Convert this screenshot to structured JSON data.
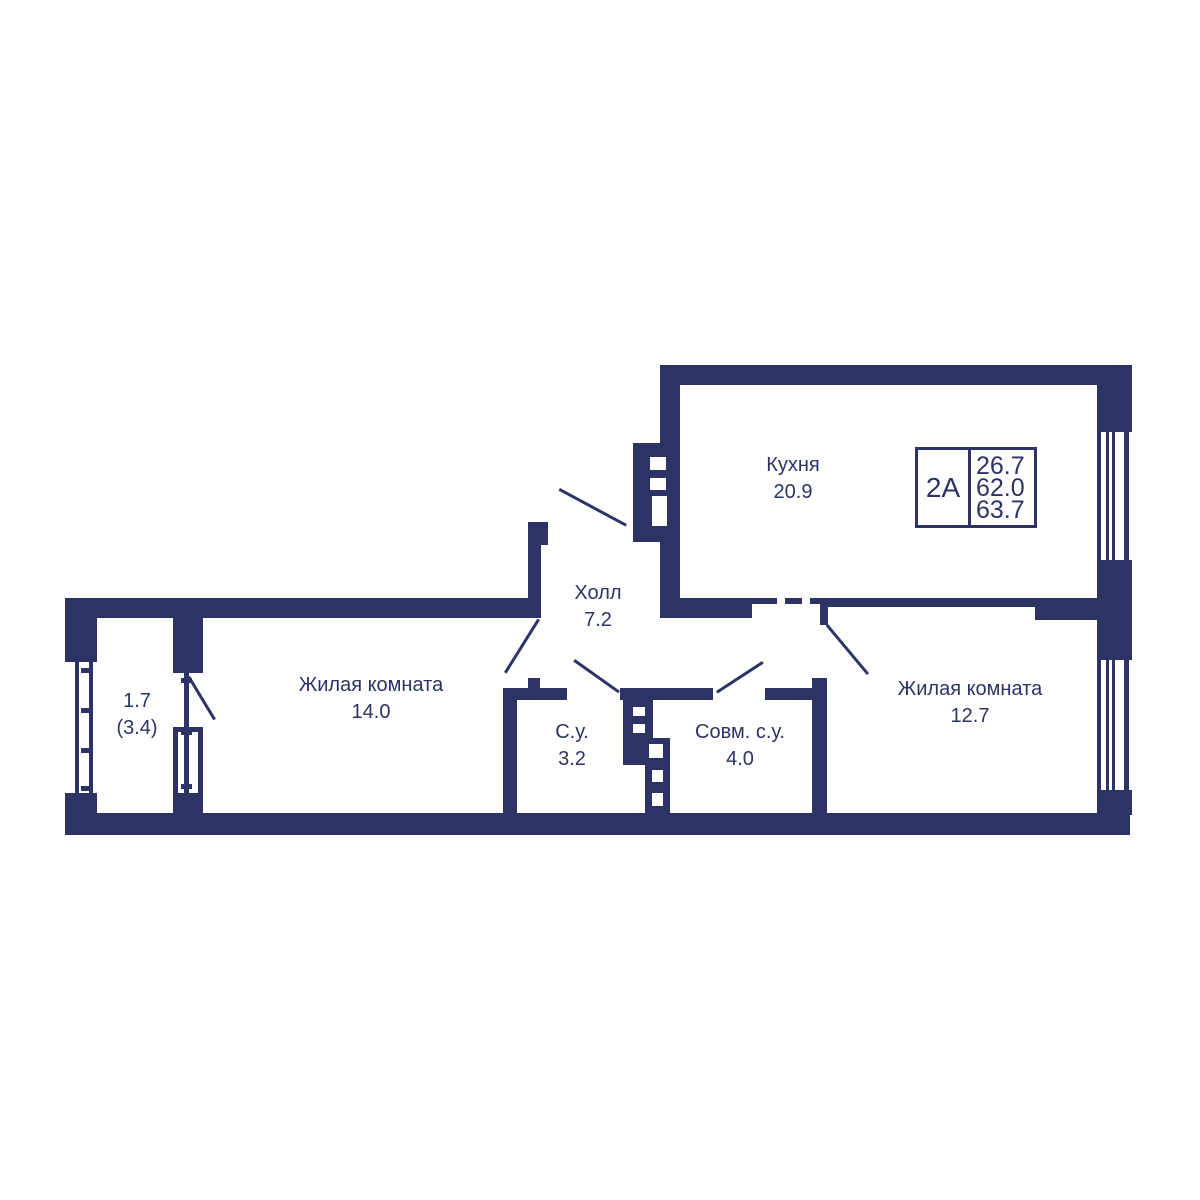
{
  "colors": {
    "wall": "#2d3364",
    "background": "#ffffff"
  },
  "apartment": {
    "type": "2А",
    "area_living": "26.7",
    "area_main": "62.0",
    "area_total": "63.7"
  },
  "rooms": [
    {
      "name": "Кухня",
      "area": "20.9"
    },
    {
      "name": "Холл",
      "area": "7.2"
    },
    {
      "name": "Жилая комната",
      "area": "14.0"
    },
    {
      "name": "Жилая комната",
      "area": "12.7"
    },
    {
      "name": "С.у.",
      "area": "3.2"
    },
    {
      "name": "Совм. с.у.",
      "area": "4.0"
    },
    {
      "area": "1.7",
      "area_secondary": "(3.4)"
    }
  ]
}
